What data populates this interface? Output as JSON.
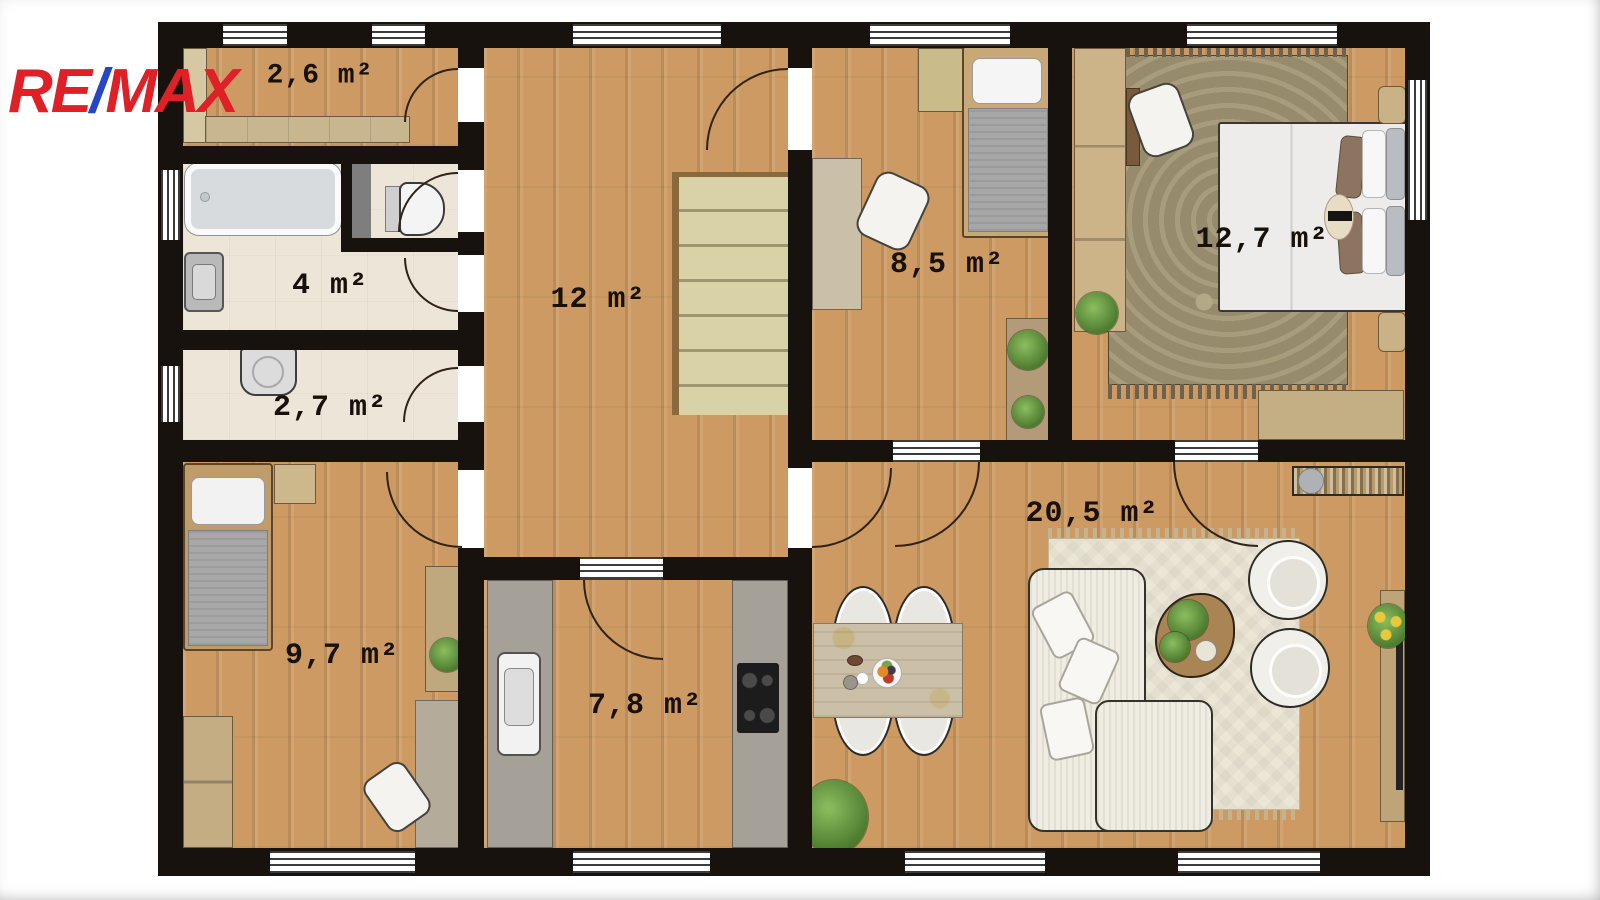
{
  "brand": {
    "re": "RE",
    "slash": "/",
    "max": "MAX",
    "red": "#e02027",
    "blue": "#2446c7"
  },
  "rooms": {
    "storage_small": {
      "label": "2,6 m²"
    },
    "bathroom": {
      "label": "4 m²"
    },
    "utility": {
      "label": "2,7 m²"
    },
    "hall": {
      "label": "12 m²"
    },
    "bedroom_small": {
      "label": "8,5 m²"
    },
    "bedroom_master": {
      "label": "12,7 m²"
    },
    "bedroom_kids": {
      "label": "9,7 m²"
    },
    "kitchen": {
      "label": "7,8 m²"
    },
    "living_room": {
      "label": "20,5 m²"
    }
  },
  "palette": {
    "wall": "#17120e",
    "wood_floor": "#cc9a62",
    "tile_floor": "#ece5d8",
    "counter_gray": "#a6a198",
    "stairs": "#d9d2a6",
    "rug_master": "#968c6d",
    "rug_living": "#ece6d7",
    "label_text": "#18100a"
  }
}
